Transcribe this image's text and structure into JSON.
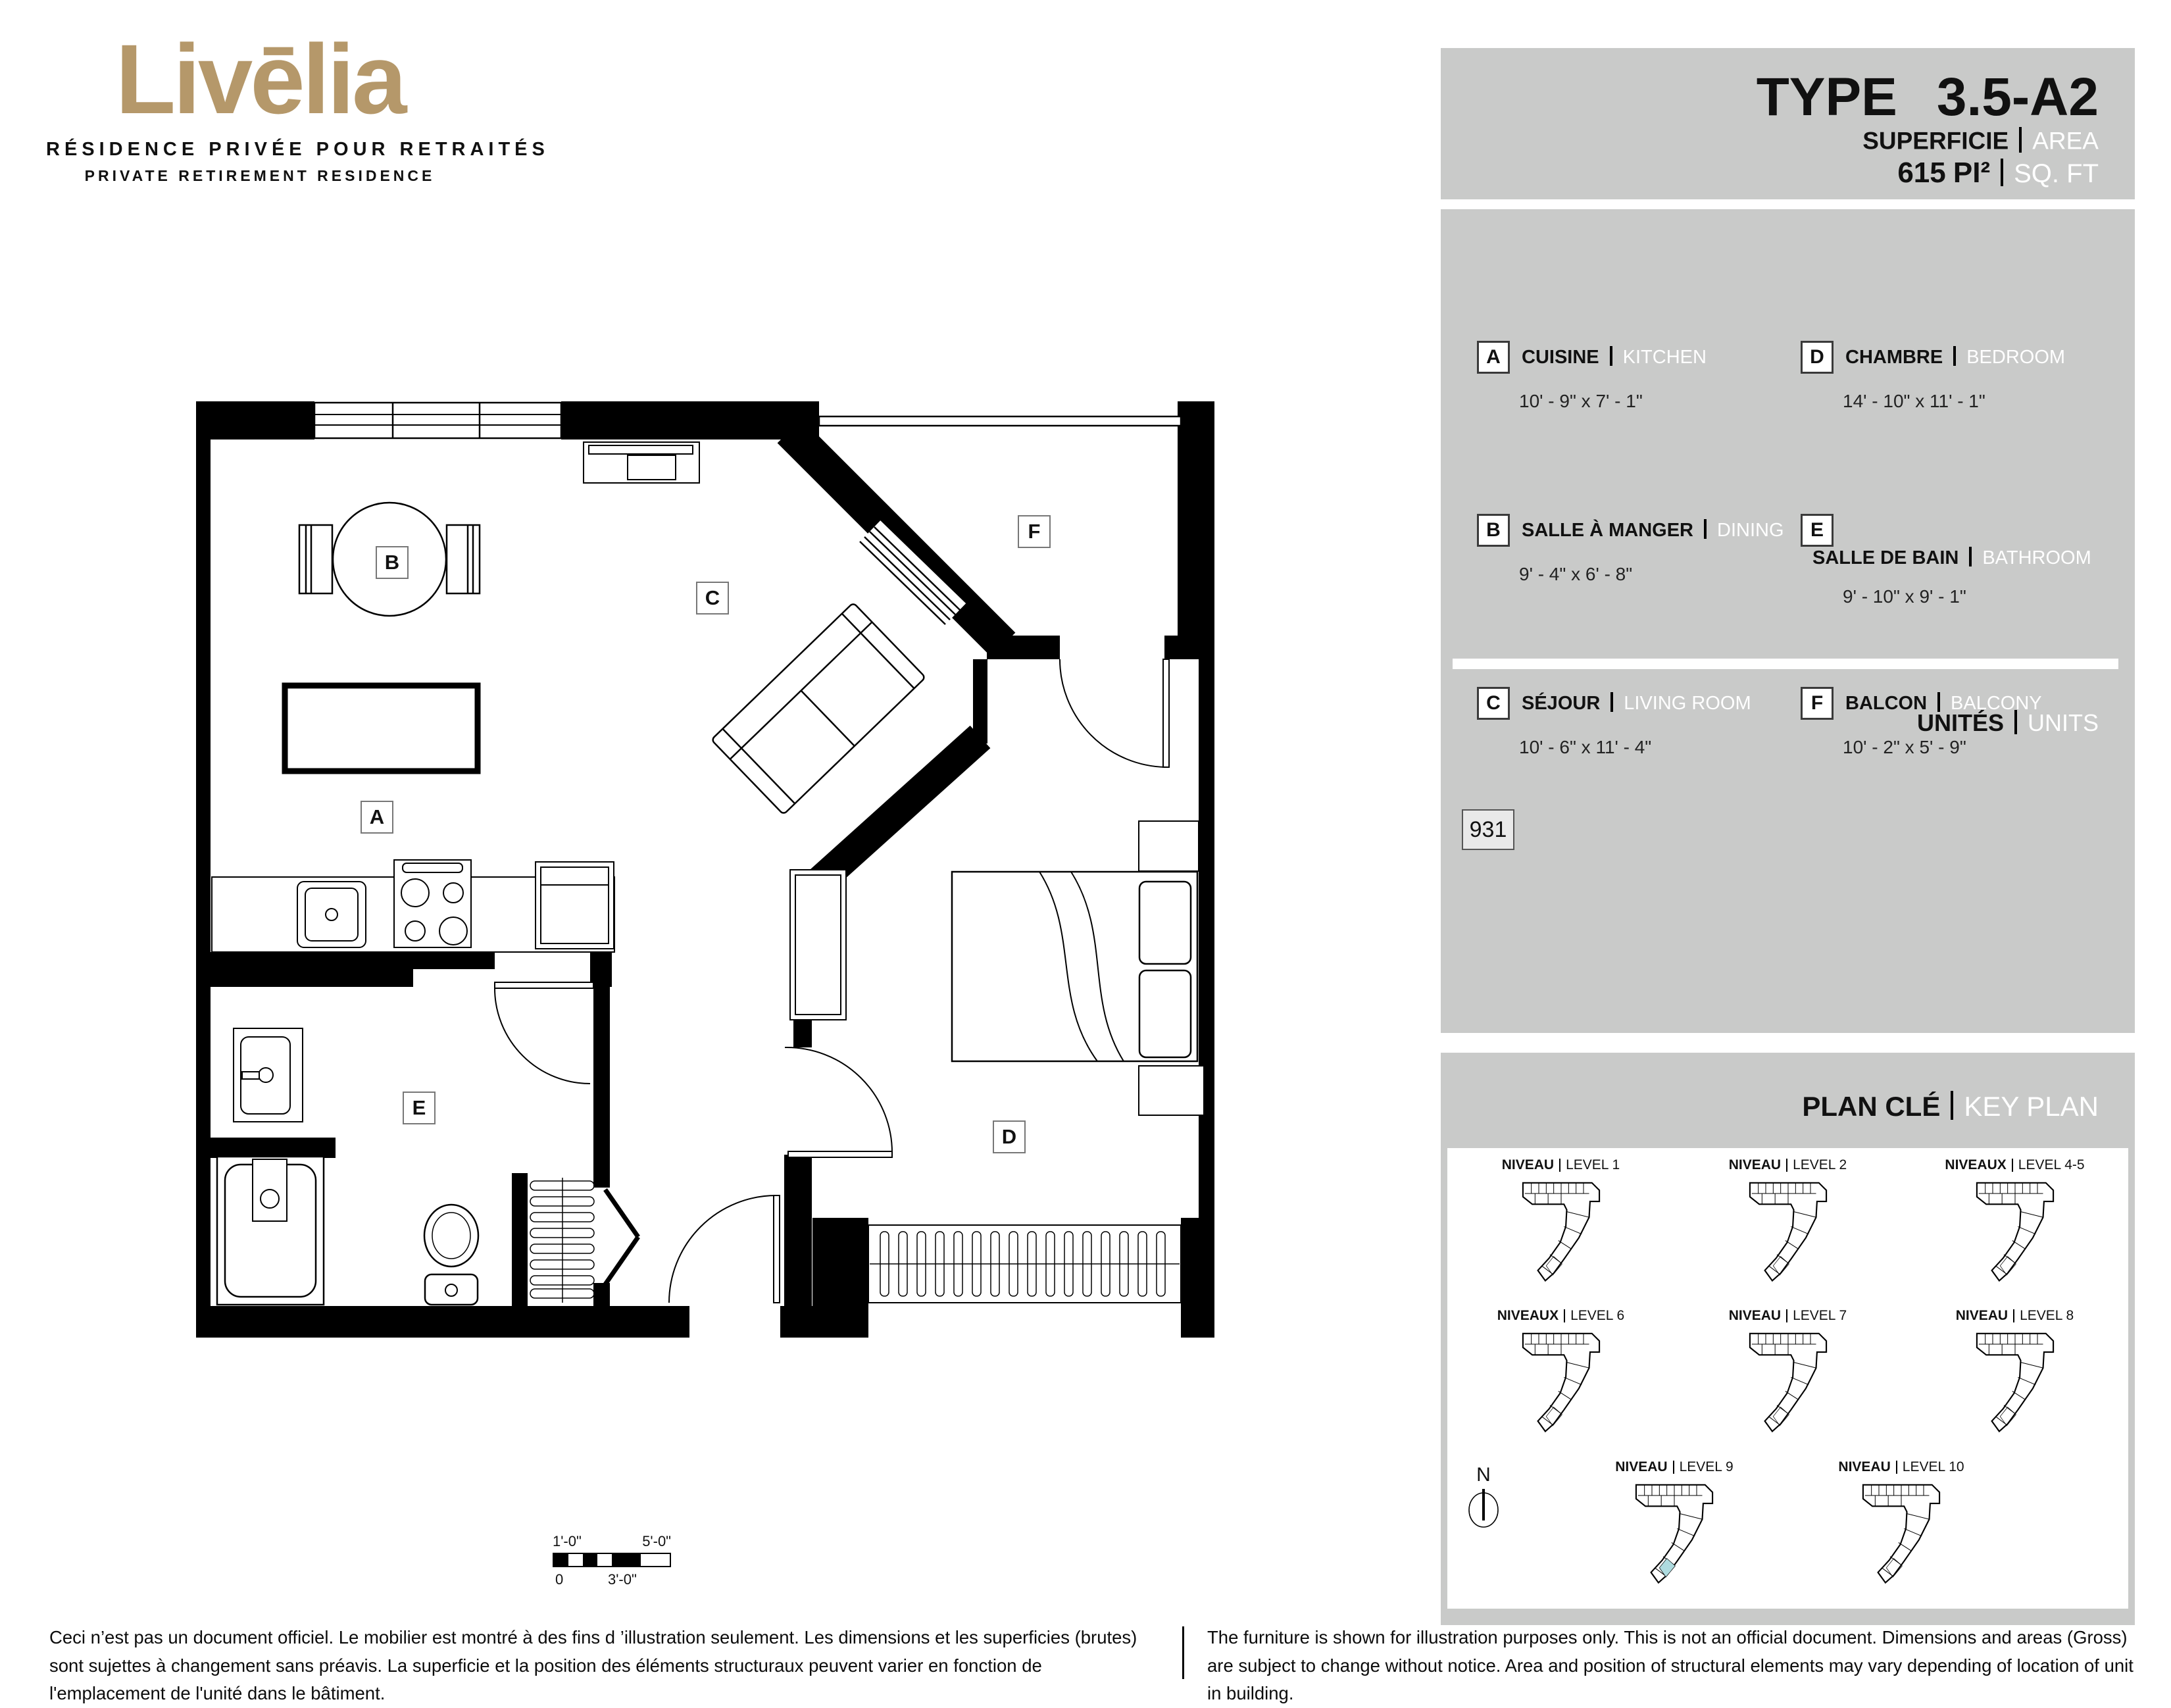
{
  "brand": {
    "logo": "Livēlia",
    "tagline_fr": "RÉSIDENCE PRIVÉE POUR RETRAITÉS",
    "tagline_en": "PRIVATE RETIREMENT RESIDENCE"
  },
  "unit_header": {
    "type_label": "TYPE",
    "type_value": "3.5-A2",
    "area_label_fr": "SUPERFICIE",
    "area_label_en": "AREA",
    "area_value": "615",
    "area_unit_fr": "PI²",
    "area_unit_en": "SQ. FT"
  },
  "legend": {
    "items": [
      {
        "letter": "A",
        "name_fr": "CUISINE",
        "name_en": "KITCHEN",
        "dims": "10' - 9\" x 7' - 1\""
      },
      {
        "letter": "B",
        "name_fr": "SALLE À MANGER",
        "name_en": "DINING",
        "dims": "9' - 4\" x 6' - 8\""
      },
      {
        "letter": "C",
        "name_fr": "SÉJOUR",
        "name_en": "LIVING ROOM",
        "dims": "10' - 6\" x 11' - 4\""
      },
      {
        "letter": "D",
        "name_fr": "CHAMBRE",
        "name_en": "BEDROOM",
        "dims": "14' - 10\" x 11' - 1\""
      },
      {
        "letter": "E",
        "name_fr": "SALLE DE BAIN",
        "name_en": "BATHROOM",
        "dims": "9' - 10\" x 9' - 1\""
      },
      {
        "letter": "F",
        "name_fr": "BALCON",
        "name_en": "BALCONY",
        "dims": "10' - 2\" x 5' - 9\""
      }
    ]
  },
  "units_section": {
    "label_fr": "UNITÉS",
    "label_en": "UNITS",
    "unit_numbers": [
      "931"
    ]
  },
  "key_plan": {
    "title_fr": "PLAN CLÉ",
    "title_en": "KEY PLAN",
    "north_label": "N",
    "levels": [
      {
        "label_fr": "NIVEAU",
        "label_en": "LEVEL 1",
        "highlighted": false
      },
      {
        "label_fr": "NIVEAU",
        "label_en": "LEVEL 2",
        "highlighted": false
      },
      {
        "label_fr": "NIVEAUX",
        "label_en": "LEVEL 4-5",
        "highlighted": false
      },
      {
        "label_fr": "NIVEAUX",
        "label_en": "LEVEL 6",
        "highlighted": false
      },
      {
        "label_fr": "NIVEAU",
        "label_en": "LEVEL 7",
        "highlighted": false
      },
      {
        "label_fr": "NIVEAU",
        "label_en": "LEVEL 8",
        "highlighted": false
      },
      {
        "label_fr": "NIVEAU",
        "label_en": "LEVEL 9",
        "highlighted": true
      },
      {
        "label_fr": "NIVEAU",
        "label_en": "LEVEL 10",
        "highlighted": false
      }
    ]
  },
  "floor_plan": {
    "room_labels": [
      "A",
      "B",
      "C",
      "D",
      "E",
      "F"
    ]
  },
  "scale_bar": {
    "top_left": "1'-0\"",
    "top_right": "5'-0\"",
    "bottom_left": "0",
    "bottom_mid": "3'-0\""
  },
  "disclaimer": {
    "fr": "Ceci n’est pas un document officiel.  Le mobilier est montré à des fins d ’illustration seulement.  Les dimensions et les superficies (brutes) sont sujettes à changement sans préavis. La superficie et la position des éléments structuraux peuvent varier en fonction de l'emplacement de l'unité dans le bâtiment.",
    "en": "The furniture is shown for illustration purposes only.  This is not an official document.  Dimensions and areas (Gross) are subject to change without notice. Area and position of structural elements may vary depending of location of unit in building."
  },
  "colors": {
    "brand_gold": "#b5986a",
    "panel_gray": "#c9cac9",
    "highlight_teal": "#aedbdf"
  }
}
